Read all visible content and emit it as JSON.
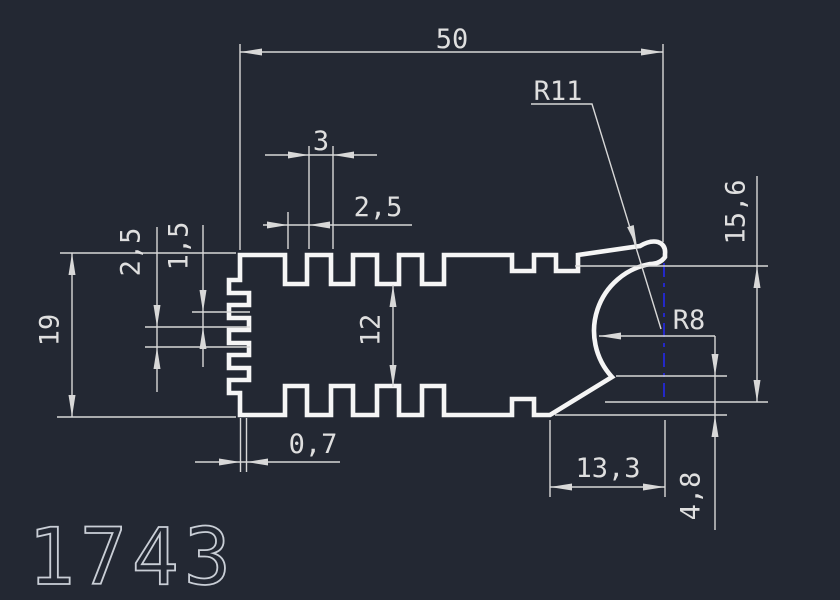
{
  "title": {
    "drawing_number": "1743"
  },
  "colors": {
    "background": "#232833",
    "line": "#d8d8d8",
    "profile": "#f5f5f5",
    "centerline": "#2328c8",
    "title": "#c9ced6",
    "text": "#dfdfdf"
  },
  "dimensions": {
    "overall_width": "50",
    "outer_radius": "R11",
    "tooth_width": "3",
    "groove_width": "2,5",
    "right_height": "15,6",
    "serration_pitch": "2,5",
    "serration_step": "1,5",
    "overall_height": "19",
    "core_height": "12",
    "inner_radius": "R8",
    "edge_offset": "0,7",
    "bottom_flat_to_center": "13,3",
    "lip_height": "4,8"
  }
}
